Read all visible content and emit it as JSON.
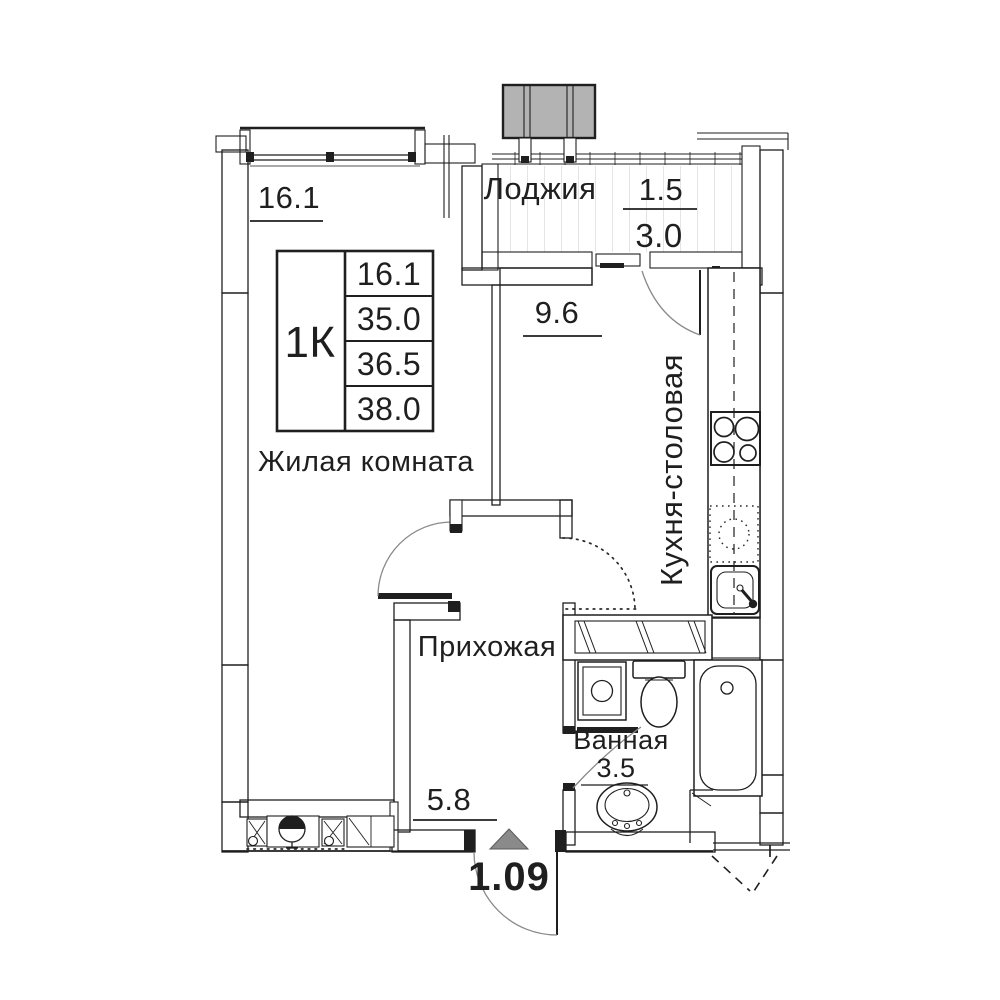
{
  "plan_title": "1K apartment floor plan",
  "apartment": {
    "type_label": "1К",
    "table_rows": [
      "16.1",
      "35.0",
      "36.5",
      "38.0"
    ]
  },
  "rooms": {
    "living": {
      "name": "Жилая комната",
      "area": "16.1"
    },
    "loggia": {
      "name": "Лоджия",
      "area_coeff": "1.5",
      "area_full": "3.0"
    },
    "kitchen": {
      "name": "Кухня-столовая",
      "area": "9.6"
    },
    "hallway": {
      "name": "Прихожая",
      "area": "5.8"
    },
    "bathroom": {
      "name": "Ванная",
      "area": "3.5"
    }
  },
  "entrance": {
    "apartment_number": "1.09"
  },
  "fixtures": [
    "ac-outdoor-unit",
    "stove-4-burners",
    "kitchen-sink",
    "appliance-slot",
    "washing-machine",
    "toilet",
    "bathtub",
    "pedestal-sink",
    "entrance-arrow",
    "condenser-basket",
    "cabinet"
  ],
  "colors": {
    "line": "#1f1f1f",
    "ac_unit_fill": "#b3b3b3",
    "entrance_arrow_fill": "#8a8a8a",
    "deck_line": "#c9c9c9"
  }
}
